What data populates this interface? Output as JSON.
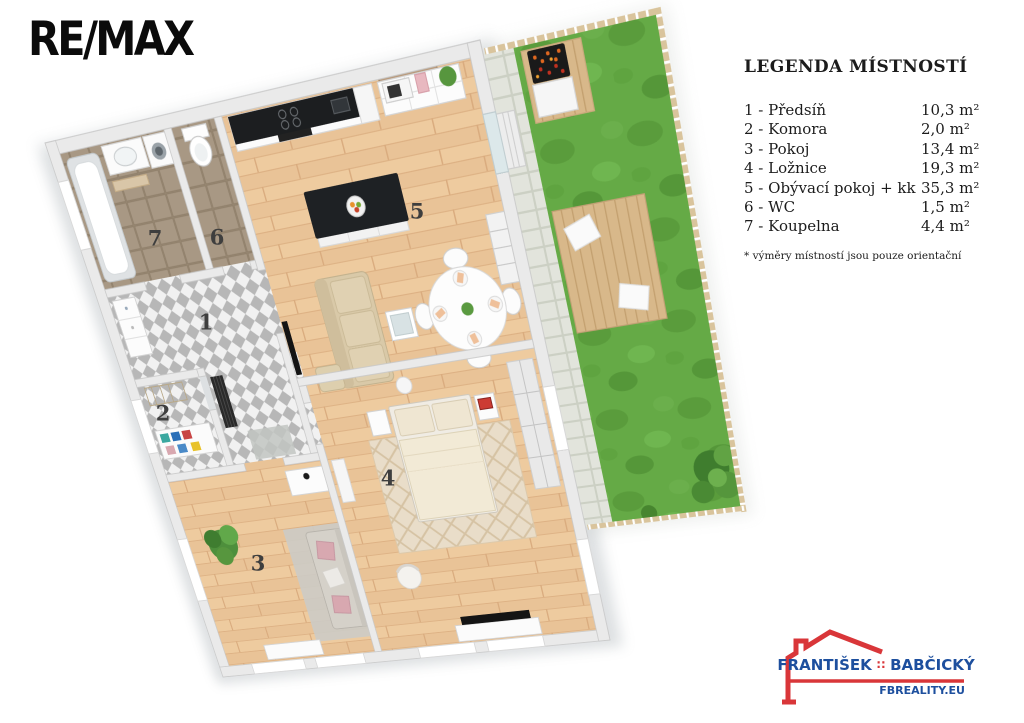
{
  "brand": {
    "remax": "RE/MAX"
  },
  "legend": {
    "title": "LEGENDA MÍSTNOSTÍ",
    "rooms": [
      {
        "number": "1",
        "label": "1 - Předsíň",
        "area": "10,3 m²"
      },
      {
        "number": "2",
        "label": "2 - Komora",
        "area": "2,0 m²"
      },
      {
        "number": "3",
        "label": "3 - Pokoj",
        "area": "13,4 m²"
      },
      {
        "number": "4",
        "label": "4 - Ložnice",
        "area": "19,3 m²"
      },
      {
        "number": "5",
        "label": "5 - Obývací pokoj + kk",
        "area": "35,3 m²"
      },
      {
        "number": "6",
        "label": "6 - WC",
        "area": "1,5 m²"
      },
      {
        "number": "7",
        "label": "7 - Koupelna",
        "area": "4,4 m²"
      }
    ],
    "footnote": "* výměry místností jsou pouze orientační"
  },
  "agent": {
    "first_name": "FRANTIŠEK",
    "separator": "∷",
    "last_name": "BABČICKÝ",
    "website": "FBREALITY.EU",
    "red": "#d93639",
    "blue": "#1d4f9e"
  },
  "colors": {
    "grass": "#65aa46",
    "wood_floor": "#edcaa0",
    "hall_tile_dark": "#b7b7b7",
    "bath_tile": "#a4947f",
    "wall": "#eaeaea",
    "counter_black": "#1c1e20"
  }
}
